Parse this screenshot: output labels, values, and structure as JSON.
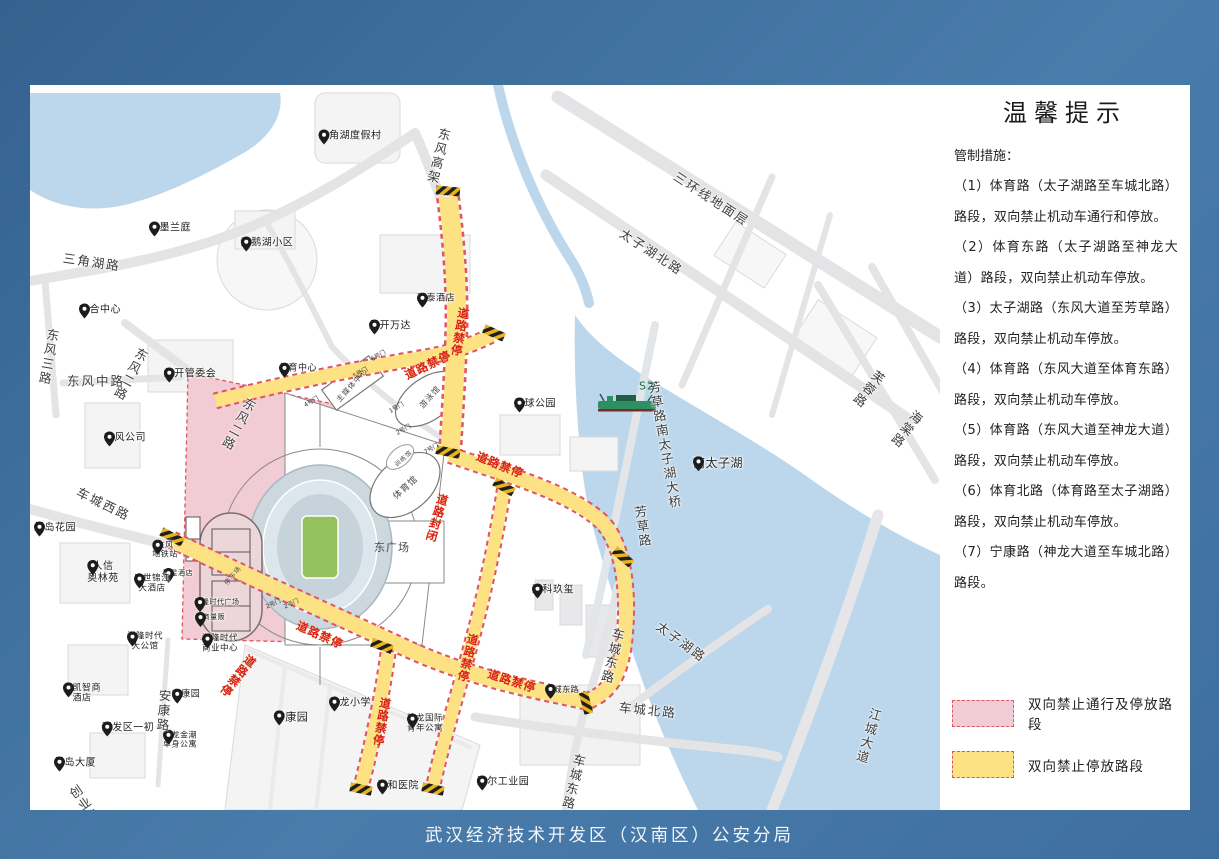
{
  "footer": {
    "agency": "武汉经济技术开发区（汉南区）公安分局"
  },
  "info_panel": {
    "title": "温馨提示",
    "intro": "管制措施：",
    "measures": [
      "（1）体育路（太子湖路至车城北路）路段，双向禁止机动车通行和停放。",
      "（2）体育东路（太子湖路至神龙大道）路段，双向禁止机动车停放。",
      "（3）太子湖路（东风大道至芳草路）路段，双向禁止机动车停放。",
      "（4）体育路（东风大道至体育东路）路段，双向禁止机动车停放。",
      "（5）体育路（东风大道至神龙大道）路段，双向禁止机动车停放。",
      "（6）体育北路（体育路至太子湖路）路段，双向禁止机动车停放。",
      "（7）宁康路（神龙大道至车城北路）路段。"
    ],
    "legend": [
      {
        "label": "双向禁止通行及停放路段",
        "fill": "#f2ccd4",
        "border": "#e0555e"
      },
      {
        "label": "双向禁止停放路段",
        "fill": "#fce283",
        "border": "#e0555e"
      }
    ]
  },
  "colors": {
    "frame_blue": "#40719f",
    "water": "#bcd7ec",
    "road_gray": "#e4e4e6",
    "no_parking_yellow": "#fce283",
    "closed_pink": "#f2ccd4",
    "restriction_red_dash": "#e0555e",
    "control_text_red": "#d8201c",
    "field_green": "#93c25c"
  },
  "map": {
    "pois": [
      {
        "label": "三角湖度假村",
        "x": 320,
        "y": 48
      },
      {
        "label": "水墨兰庭",
        "x": 140,
        "y": 140
      },
      {
        "label": "天鹅湖小区",
        "x": 237,
        "y": 155
      },
      {
        "label": "东合中心",
        "x": 70,
        "y": 222
      },
      {
        "label": "万泰酒店",
        "x": 406,
        "y": 210,
        "size": 9
      },
      {
        "label": "经开万达",
        "x": 360,
        "y": 238
      },
      {
        "label": "经开管委会",
        "x": 160,
        "y": 286
      },
      {
        "label": "东风公司",
        "x": 95,
        "y": 350
      },
      {
        "label": "体育中心",
        "x": 268,
        "y": 280,
        "size": 9
      },
      {
        "label": "足球公园",
        "x": 505,
        "y": 316
      },
      {
        "label": "南太子湖",
        "x": 688,
        "y": 377,
        "size": 12
      },
      {
        "label": "绿岛花园",
        "x": 25,
        "y": 440
      },
      {
        "label": "人信\n奥林苑",
        "x": 73,
        "y": 490
      },
      {
        "label": "丽星酒店",
        "x": 148,
        "y": 483,
        "size": 7
      },
      {
        "label": "盛世锦江\n大酒店",
        "x": 122,
        "y": 500,
        "size": 8.5
      },
      {
        "label": "湘隆时代广场",
        "x": 187,
        "y": 512,
        "size": 7
      },
      {
        "label": "武商量贩",
        "x": 180,
        "y": 527,
        "size": 7
      },
      {
        "label": "湘隆时代\n大公馆",
        "x": 115,
        "y": 558,
        "size": 8.5
      },
      {
        "label": "湘隆时代\n商业中心",
        "x": 190,
        "y": 560,
        "size": 8.5
      },
      {
        "label": "金凯智商\n酒店",
        "x": 52,
        "y": 610,
        "size": 9
      },
      {
        "label": "安康园",
        "x": 156,
        "y": 606,
        "size": 9
      },
      {
        "label": "开发区一初",
        "x": 98,
        "y": 640
      },
      {
        "label": "神龙金潮\n单身公寓",
        "x": 150,
        "y": 655,
        "size": 8
      },
      {
        "label": "绿岛大厦",
        "x": 45,
        "y": 675
      },
      {
        "label": "宁康园",
        "x": 261,
        "y": 630,
        "size": 11
      },
      {
        "label": "神龙小学",
        "x": 320,
        "y": 615
      },
      {
        "label": "神龙国际\n青年公寓",
        "x": 395,
        "y": 640,
        "size": 8.5
      },
      {
        "label": "万科玖玺",
        "x": 523,
        "y": 502
      },
      {
        "label": "车城东路",
        "x": 532,
        "y": 600,
        "size": 8
      },
      {
        "label": "协和医院",
        "x": 368,
        "y": 698
      },
      {
        "label": "海尔工业园",
        "x": 473,
        "y": 694
      },
      {
        "label": "东风\n地铁站",
        "x": 135,
        "y": 465,
        "size": 8
      }
    ],
    "road_labels": [
      {
        "text": "三角湖路",
        "x": 62,
        "y": 176,
        "rot": 8
      },
      {
        "text": "东风三路",
        "x": 18,
        "y": 243,
        "rot": 10,
        "v": true
      },
      {
        "text": "东风二路",
        "x": 100,
        "y": 260,
        "rot": 28,
        "v": true
      },
      {
        "text": "东风中路",
        "x": 66,
        "y": 295,
        "rot": 0
      },
      {
        "text": "东风二路",
        "x": 208,
        "y": 310,
        "rot": 28,
        "v": true
      },
      {
        "text": "东风高架",
        "x": 408,
        "y": 42,
        "rot": 14,
        "v": true
      },
      {
        "text": "三环线地面层",
        "x": 682,
        "y": 113,
        "rot": 33
      },
      {
        "text": "太子湖北路",
        "x": 622,
        "y": 166,
        "rot": 33
      },
      {
        "text": "芙蓉路",
        "x": 838,
        "y": 282,
        "rot": 38,
        "v": true
      },
      {
        "text": "海棠路",
        "x": 876,
        "y": 322,
        "rot": 38,
        "v": true
      },
      {
        "text": "车城西路",
        "x": 74,
        "y": 418,
        "rot": 26
      },
      {
        "text": "芳草路南太子湖大桥",
        "x": 634,
        "y": 295,
        "rot": -10,
        "v": true
      },
      {
        "text": "芳草路",
        "x": 612,
        "y": 420,
        "rot": -8,
        "v": true
      },
      {
        "text": "车城东路",
        "x": 582,
        "y": 542,
        "rot": 14,
        "v": true
      },
      {
        "text": "太子湖路",
        "x": 652,
        "y": 556,
        "rot": 36
      },
      {
        "text": "车城北路",
        "x": 618,
        "y": 624,
        "rot": 6
      },
      {
        "text": "车城东路",
        "x": 543,
        "y": 668,
        "rot": 14,
        "v": true
      },
      {
        "text": "江城大道",
        "x": 838,
        "y": 622,
        "rot": 16,
        "v": true
      },
      {
        "text": "安康路",
        "x": 133,
        "y": 604,
        "rot": 4,
        "v": true
      },
      {
        "text": "创业路",
        "x": 54,
        "y": 698,
        "rot": -35,
        "v": true
      }
    ],
    "control_labels": [
      {
        "text": "道路禁停",
        "x": 430,
        "y": 222,
        "rot": 10,
        "v": true
      },
      {
        "text": "道路禁停",
        "x": 398,
        "y": 280,
        "rot": -26
      },
      {
        "text": "道路禁停",
        "x": 470,
        "y": 380,
        "rot": 22
      },
      {
        "text": "道路禁停",
        "x": 290,
        "y": 550,
        "rot": 24
      },
      {
        "text": "道路禁停",
        "x": 482,
        "y": 596,
        "rot": 18
      },
      {
        "text": "道路禁停",
        "x": 208,
        "y": 566,
        "rot": 38,
        "v": true
      },
      {
        "text": "道路禁停",
        "x": 352,
        "y": 612,
        "rot": 10,
        "v": true
      },
      {
        "text": "道路禁停",
        "x": 438,
        "y": 548,
        "rot": 14,
        "v": true
      },
      {
        "text": "道路封闭",
        "x": 407,
        "y": 408,
        "rot": 16,
        "v": true
      }
    ],
    "gate_labels": [
      {
        "text": "4号门",
        "x": 281,
        "y": 316,
        "rot": -30
      },
      {
        "text": "5号门",
        "x": 330,
        "y": 287,
        "rot": -30
      },
      {
        "text": "6号门",
        "x": 348,
        "y": 270,
        "rot": -30
      },
      {
        "text": "1号门",
        "x": 366,
        "y": 322,
        "rot": -30
      },
      {
        "text": "2号门",
        "x": 373,
        "y": 344,
        "rot": -30
      },
      {
        "text": "7号门",
        "x": 401,
        "y": 363,
        "rot": -30
      },
      {
        "text": "2号门",
        "x": 243,
        "y": 518,
        "rot": -25
      },
      {
        "text": "2号门",
        "x": 261,
        "y": 518,
        "rot": -25
      }
    ],
    "building_labels": [
      {
        "text": "主媒体中心",
        "x": 322,
        "y": 300,
        "rot": -48,
        "size": 7.5
      },
      {
        "text": "游泳馆",
        "x": 400,
        "y": 312,
        "rot": -48,
        "size": 8
      },
      {
        "text": "体育馆",
        "x": 375,
        "y": 402,
        "rot": -42,
        "size": 9
      },
      {
        "text": "训练馆",
        "x": 373,
        "y": 373,
        "rot": -42,
        "size": 6
      },
      {
        "text": "东广场",
        "x": 362,
        "y": 462,
        "rot": 0,
        "size": 11
      },
      {
        "text": "停车场",
        "x": 202,
        "y": 490,
        "rot": -50,
        "size": 6.5
      },
      {
        "text": "S2",
        "x": 617,
        "y": 301,
        "rot": 0,
        "size": 11,
        "color": "#1d6e4c"
      }
    ]
  }
}
